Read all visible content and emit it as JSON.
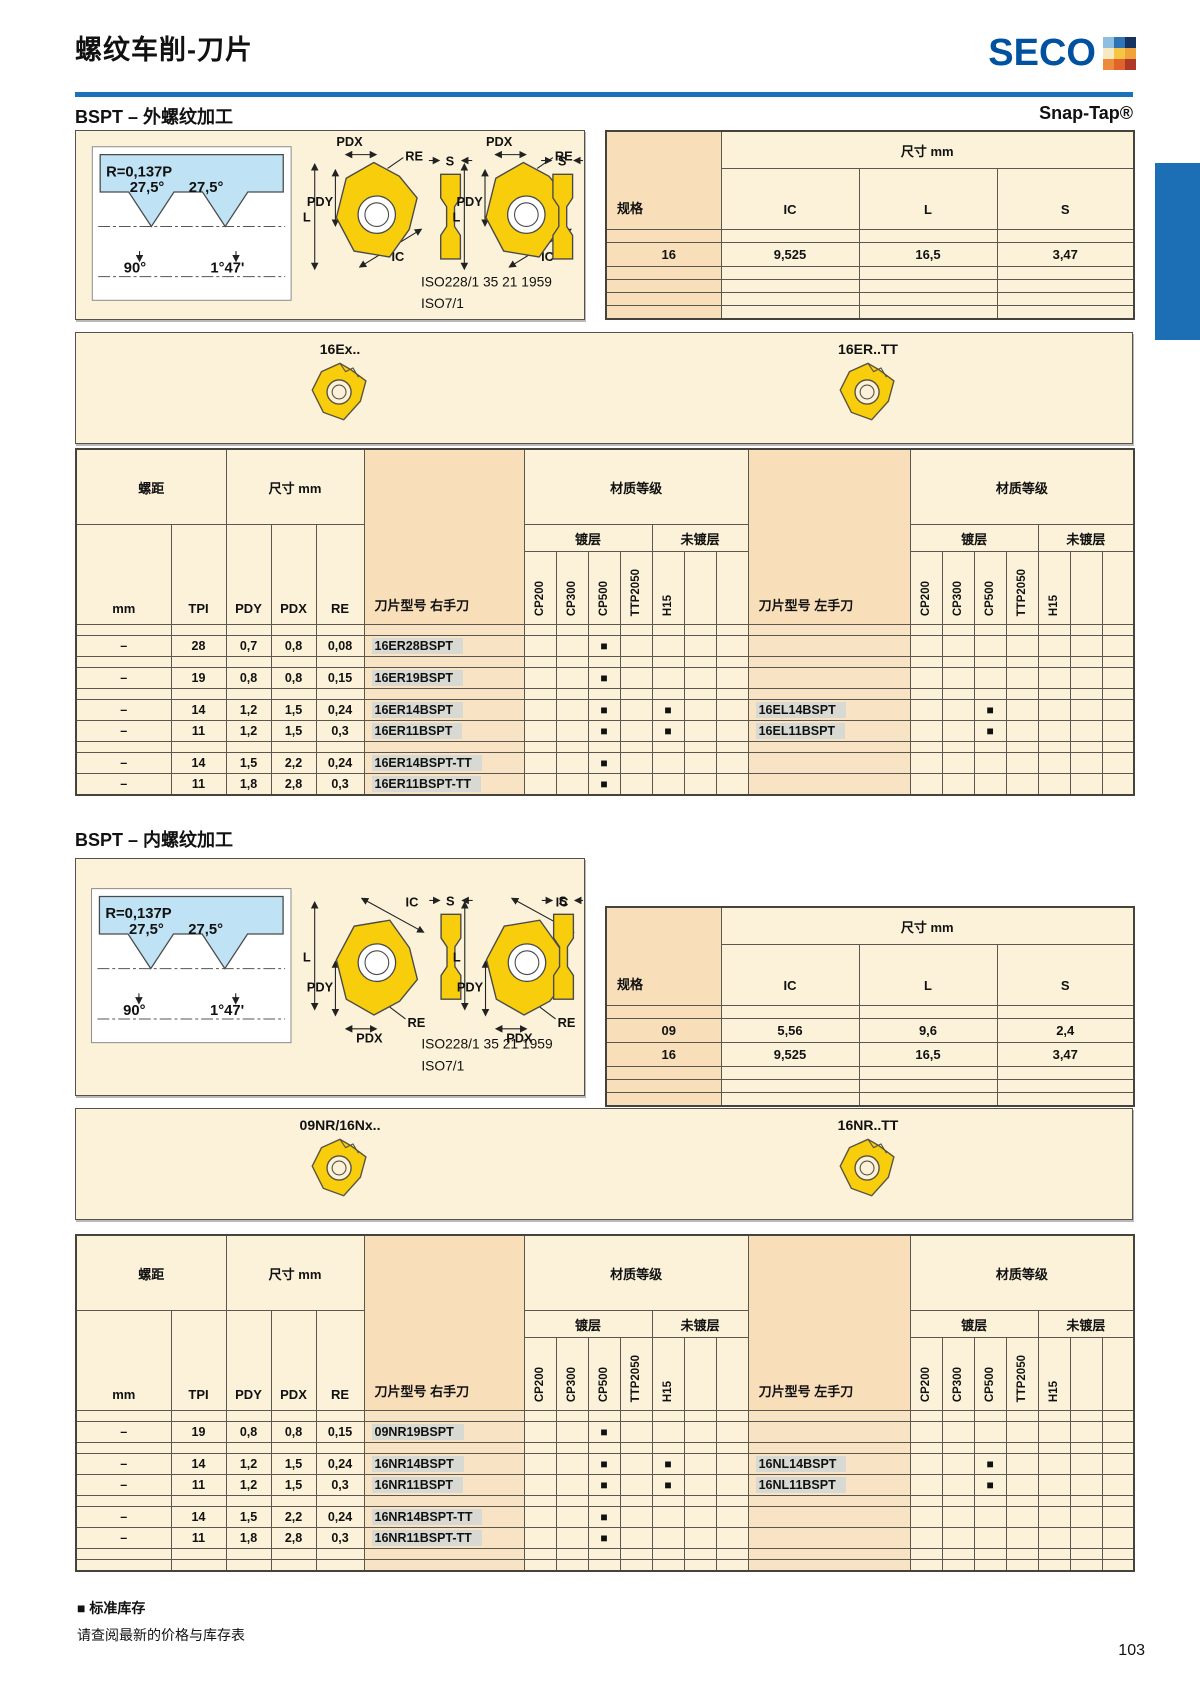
{
  "header": {
    "title": "螺纹车削-刀片",
    "brand_word": "SECO"
  },
  "logo_colors": [
    "#8FBFE0",
    "#2F74B5",
    "#15335E",
    "#F6E9C4",
    "#F5C544",
    "#F0A33C",
    "#EC8C3A",
    "#E2622B",
    "#AD3A28"
  ],
  "accent": {
    "rule_blue": "#1B72B8",
    "tab_blue": "#1C6FB5",
    "seco_blue": "#00519F"
  },
  "footer": {
    "legend_mark": "■",
    "legend_text": "标准库存",
    "note": "请查阅最新的价格与库存表",
    "page_number": "103"
  },
  "sections": [
    {
      "heading": "BSPT – 外螺纹加工",
      "corner_label": "Snap-Tap®",
      "diagram": {
        "thread": {
          "r": "R=0,137P",
          "a_left": "27,5°",
          "a_right": "27,5°",
          "a_bottom": "90°",
          "a_taper": "1°47'"
        },
        "dims": {
          "pdx": "PDX",
          "pdy": "PDY",
          "re": "RE",
          "l": "L",
          "ic": "IC",
          "s": "S"
        },
        "iso1": "ISO228/1 35 21 1959",
        "iso2": "ISO7/1"
      },
      "spec_table": {
        "spec_label": "规格",
        "dim_label": "尺寸 mm",
        "columns": [
          "IC",
          "L",
          "S"
        ],
        "rows": [
          [
            "",
            "",
            "",
            ""
          ],
          [
            "16",
            "9,525",
            "16,5",
            "3,47"
          ],
          [
            "",
            "",
            "",
            ""
          ],
          [
            "",
            "",
            "",
            ""
          ],
          [
            "",
            "",
            "",
            ""
          ],
          [
            "",
            "",
            "",
            ""
          ]
        ]
      },
      "strip": {
        "left_label": "16Ex..",
        "right_label": "16ER..TT"
      },
      "table": {
        "pitch_label": "螺距",
        "dim_label": "尺寸 mm",
        "grade_label": "材质等级",
        "coated_label": "镀层",
        "uncoated_label": "未镀层",
        "col_mm": "mm",
        "col_tpi": "TPI",
        "col_pdy": "PDY",
        "col_pdx": "PDX",
        "col_re": "RE",
        "rh_label": "刀片型号 右手刀",
        "lh_label": "刀片型号 左手刀",
        "grades": [
          "CP200",
          "CP300",
          "CP500",
          "TTP2050",
          "H15"
        ],
        "rows": [
          [
            "",
            "",
            "",
            "",
            "",
            "",
            "",
            "",
            "",
            "",
            "",
            "",
            "",
            "",
            "",
            "",
            "",
            "",
            "",
            "",
            ""
          ],
          [
            "–",
            "28",
            "0,7",
            "0,8",
            "0,08",
            "16ER28BSPT",
            "",
            "",
            "■",
            "",
            "",
            "",
            "",
            "",
            "",
            "",
            "",
            "",
            "",
            "",
            ""
          ],
          [
            "",
            "",
            "",
            "",
            "",
            "",
            "",
            "",
            "",
            "",
            "",
            "",
            "",
            "",
            "",
            "",
            "",
            "",
            "",
            "",
            ""
          ],
          [
            "–",
            "19",
            "0,8",
            "0,8",
            "0,15",
            "16ER19BSPT",
            "",
            "",
            "■",
            "",
            "",
            "",
            "",
            "",
            "",
            "",
            "",
            "",
            "",
            "",
            ""
          ],
          [
            "",
            "",
            "",
            "",
            "",
            "",
            "",
            "",
            "",
            "",
            "",
            "",
            "",
            "",
            "",
            "",
            "",
            "",
            "",
            "",
            ""
          ],
          [
            "–",
            "14",
            "1,2",
            "1,5",
            "0,24",
            "16ER14BSPT",
            "",
            "",
            "■",
            "",
            "■",
            "",
            "",
            "16EL14BSPT",
            "",
            "",
            "■",
            "",
            "",
            "",
            ""
          ],
          [
            "–",
            "11",
            "1,2",
            "1,5",
            "0,3",
            "16ER11BSPT",
            "",
            "",
            "■",
            "",
            "■",
            "",
            "",
            "16EL11BSPT",
            "",
            "",
            "■",
            "",
            "",
            "",
            ""
          ],
          [
            "",
            "",
            "",
            "",
            "",
            "",
            "",
            "",
            "",
            "",
            "",
            "",
            "",
            "",
            "",
            "",
            "",
            "",
            "",
            "",
            ""
          ],
          [
            "–",
            "14",
            "1,5",
            "2,2",
            "0,24",
            "16ER14BSPT-TT",
            "",
            "",
            "■",
            "",
            "",
            "",
            "",
            "",
            "",
            "",
            "",
            "",
            "",
            "",
            ""
          ],
          [
            "–",
            "11",
            "1,8",
            "2,8",
            "0,3",
            "16ER11BSPT-TT",
            "",
            "",
            "■",
            "",
            "",
            "",
            "",
            "",
            "",
            "",
            "",
            "",
            "",
            "",
            ""
          ]
        ]
      }
    },
    {
      "heading": "BSPT – 内螺纹加工",
      "corner_label": "",
      "diagram": {
        "thread": {
          "r": "R=0,137P",
          "a_left": "27,5°",
          "a_right": "27,5°",
          "a_bottom": "90°",
          "a_taper": "1°47'"
        },
        "dims": {
          "pdx": "PDX",
          "pdy": "PDY",
          "re": "RE",
          "l": "L",
          "ic": "IC",
          "s": "S"
        },
        "iso1": "ISO228/1 35 21 1959",
        "iso2": "ISO7/1"
      },
      "spec_table": {
        "spec_label": "规格",
        "dim_label": "尺寸 mm",
        "columns": [
          "IC",
          "L",
          "S"
        ],
        "rows": [
          [
            "",
            "",
            "",
            ""
          ],
          [
            "09",
            "5,56",
            "9,6",
            "2,4"
          ],
          [
            "16",
            "9,525",
            "16,5",
            "3,47"
          ],
          [
            "",
            "",
            "",
            ""
          ],
          [
            "",
            "",
            "",
            ""
          ],
          [
            "",
            "",
            "",
            ""
          ]
        ]
      },
      "strip": {
        "left_label": "09NR/16Nx..",
        "right_label": "16NR..TT"
      },
      "table": {
        "pitch_label": "螺距",
        "dim_label": "尺寸 mm",
        "grade_label": "材质等级",
        "coated_label": "镀层",
        "uncoated_label": "未镀层",
        "col_mm": "mm",
        "col_tpi": "TPI",
        "col_pdy": "PDY",
        "col_pdx": "PDX",
        "col_re": "RE",
        "rh_label": "刀片型号 右手刀",
        "lh_label": "刀片型号 左手刀",
        "grades": [
          "CP200",
          "CP300",
          "CP500",
          "TTP2050",
          "H15"
        ],
        "rows": [
          [
            "",
            "",
            "",
            "",
            "",
            "",
            "",
            "",
            "",
            "",
            "",
            "",
            "",
            "",
            "",
            "",
            "",
            "",
            "",
            "",
            ""
          ],
          [
            "–",
            "19",
            "0,8",
            "0,8",
            "0,15",
            "09NR19BSPT",
            "",
            "",
            "■",
            "",
            "",
            "",
            "",
            "",
            "",
            "",
            "",
            "",
            "",
            "",
            ""
          ],
          [
            "",
            "",
            "",
            "",
            "",
            "",
            "",
            "",
            "",
            "",
            "",
            "",
            "",
            "",
            "",
            "",
            "",
            "",
            "",
            "",
            ""
          ],
          [
            "–",
            "14",
            "1,2",
            "1,5",
            "0,24",
            "16NR14BSPT",
            "",
            "",
            "■",
            "",
            "■",
            "",
            "",
            "16NL14BSPT",
            "",
            "",
            "■",
            "",
            "",
            "",
            ""
          ],
          [
            "–",
            "11",
            "1,2",
            "1,5",
            "0,3",
            "16NR11BSPT",
            "",
            "",
            "■",
            "",
            "■",
            "",
            "",
            "16NL11BSPT",
            "",
            "",
            "■",
            "",
            "",
            "",
            ""
          ],
          [
            "",
            "",
            "",
            "",
            "",
            "",
            "",
            "",
            "",
            "",
            "",
            "",
            "",
            "",
            "",
            "",
            "",
            "",
            "",
            "",
            ""
          ],
          [
            "–",
            "14",
            "1,5",
            "2,2",
            "0,24",
            "16NR14BSPT-TT",
            "",
            "",
            "■",
            "",
            "",
            "",
            "",
            "",
            "",
            "",
            "",
            "",
            "",
            "",
            ""
          ],
          [
            "–",
            "11",
            "1,8",
            "2,8",
            "0,3",
            "16NR11BSPT-TT",
            "",
            "",
            "■",
            "",
            "",
            "",
            "",
            "",
            "",
            "",
            "",
            "",
            "",
            "",
            ""
          ],
          [
            "",
            "",
            "",
            "",
            "",
            "",
            "",
            "",
            "",
            "",
            "",
            "",
            "",
            "",
            "",
            "",
            "",
            "",
            "",
            "",
            ""
          ],
          [
            "",
            "",
            "",
            "",
            "",
            "",
            "",
            "",
            "",
            "",
            "",
            "",
            "",
            "",
            "",
            "",
            "",
            "",
            "",
            "",
            ""
          ]
        ]
      }
    }
  ]
}
